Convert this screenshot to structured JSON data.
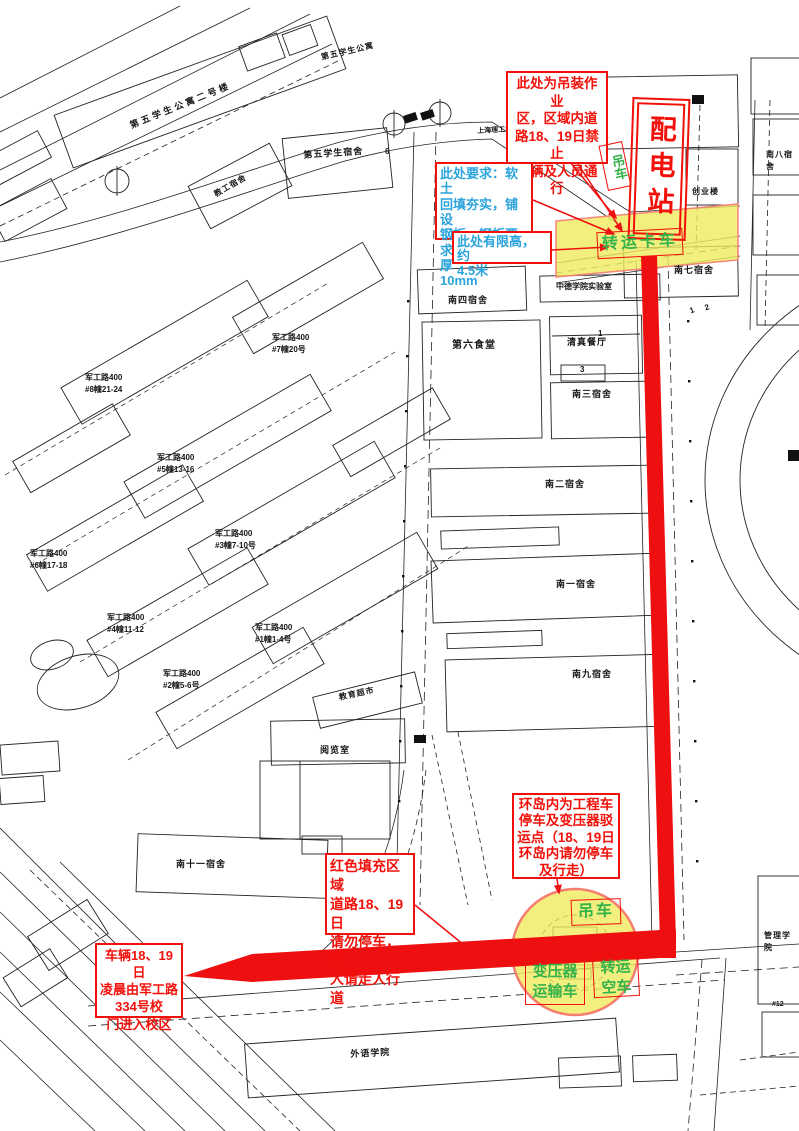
{
  "map": {
    "callouts": {
      "hoisting_zone": "此处为吊装作业\n区，区域内道\n路18、19日禁止\n车辆及人员通行",
      "ground_requirement": "此处要求：软土\n回填夯实，铺设\n钢板，钢板要\n求：8米*12米厚\n10mm",
      "height_limit": "此处有限高，约\n4.5米",
      "roundabout_notice": "环岛内为工程车\n停车及变压器驳\n运点（18、19日\n环岛内请勿停车\n及行走）",
      "red_fill_notice": "红色填充区域\n道路18、19日\n请勿停车，行\n人请走人行道",
      "vehicle_entry": "车辆18、19日\n凌晨由军工路\n334号校\n门进入校区"
    },
    "equipment": {
      "power_station": "配电站",
      "crane_top": "吊车",
      "transfer_truck": "转运卡车",
      "crane_bottom": "吊车",
      "transformer_truck": "变压器\n运输车",
      "empty_transfer_truck": "转运\n空车"
    },
    "buildings": {
      "fifth_apartment_2": "第五学生公寓二号楼",
      "fifth_apartment": "第五学生公寓",
      "fifth_dorm": "第五学生宿舍",
      "staff_dorm": "教工宿舍",
      "usst": "上海理工大学",
      "chuangye_building": "创业楼",
      "nan8_dorm": "南八宿舍",
      "nan7_dorm": "南七宿舍",
      "zhongde_lab": "中德学院实验室",
      "nan4_dorm": "南四宿舍",
      "qingzhen_restaurant": "清真餐厅",
      "no6_canteen": "第六食堂",
      "nan3_dorm": "南三宿舍",
      "nan2_dorm": "南二宿舍",
      "nan1_dorm": "南一宿舍",
      "nan9_dorm": "南九宿舍",
      "edu_market": "教育超市",
      "reading_room": "阅览室",
      "nan11_dorm": "南十一宿舍",
      "foreign_lang": "外语学院",
      "management": "管理学院",
      "jungong_8": "军工路400\n#8幢21-24",
      "jungong_7": "军工路400\n#7幢20号",
      "jungong_5": "军工路400\n#5幢13-16",
      "jungong_3": "军工路400\n#3幢7-10号",
      "jungong_6": "军工路400\n#6幢17-18",
      "jungong_4": "军工路400\n#4幢11-12",
      "jungong_1": "军工路400\n#1幢1-4号",
      "jungong_2": "军工路400\n#2幢5-6号"
    },
    "plot_numbers": {
      "n6": "6",
      "n1": "1",
      "n3": "3",
      "p1": "1",
      "p2": "2",
      "n12": "#12"
    },
    "colors": {
      "route_red": "#ee1010",
      "note_red": "#f2100a",
      "info_cyan": "#2ba4dc",
      "equip_green": "#35b34a",
      "zone_yellow": "#f0eb5f"
    }
  }
}
